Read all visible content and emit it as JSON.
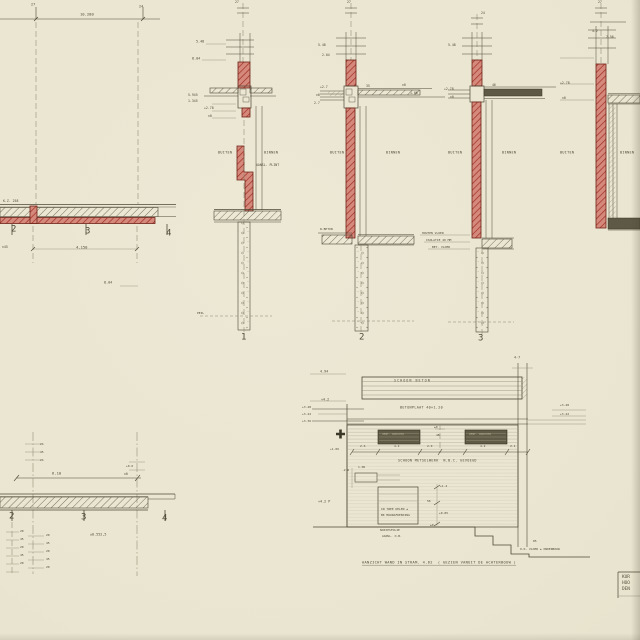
{
  "title_block": {
    "line1": "KUR",
    "line2": "HOO",
    "line3": "DEN"
  },
  "caption": "AANZICHT WAND IN STRAM. 4.62  ( GEZIEN VANUIT DE ACHTERBOUW )",
  "colors": {
    "paper": "#e9e5d0",
    "ink": "#4d4836",
    "red_fill": "#d5897c",
    "red_hatch": "#9e2f22",
    "dark_slab": "#5e5946",
    "faint": "#8a8570"
  },
  "annotations": [
    {
      "t": "27",
      "x": 31,
      "y": 3,
      "s": 3.5
    },
    {
      "t": "24",
      "x": 139,
      "y": 5,
      "s": 3.5
    },
    {
      "t": "10.280",
      "x": 80,
      "y": 13,
      "s": 3.8
    },
    {
      "t": "K.Z. 258",
      "x": 3,
      "y": 200,
      "s": 3.2
    },
    {
      "t": "2",
      "x": 11,
      "y": 225,
      "s": 9,
      "n": "grid-number-2"
    },
    {
      "t": "3",
      "x": 85,
      "y": 227,
      "s": 9,
      "n": "grid-number-3"
    },
    {
      "t": "4",
      "x": 166,
      "y": 229,
      "s": 9,
      "n": "grid-number-4"
    },
    {
      "t": "±45",
      "x": 2,
      "y": 246,
      "s": 3.2
    },
    {
      "t": "4.150",
      "x": 76,
      "y": 246,
      "s": 3.8
    },
    {
      "t": "8.04",
      "x": 104,
      "y": 281,
      "s": 3.4
    },
    {
      "t": "27",
      "x": 235,
      "y": 1,
      "s": 3.2
    },
    {
      "t": "27",
      "x": 347,
      "y": 1,
      "s": 3.2
    },
    {
      "t": "24",
      "x": 481,
      "y": 12,
      "s": 3.2
    },
    {
      "t": "27",
      "x": 598,
      "y": 1,
      "s": 3.2
    },
    {
      "t": "5.48",
      "x": 196,
      "y": 40,
      "s": 3.4
    },
    {
      "t": "8.04",
      "x": 192,
      "y": 57,
      "s": 3.4
    },
    {
      "t": "5.945",
      "x": 188,
      "y": 94,
      "s": 3.2
    },
    {
      "t": "1.345",
      "x": 188,
      "y": 100,
      "s": 3.2
    },
    {
      "t": "+2.78",
      "x": 204,
      "y": 107,
      "s": 3.2
    },
    {
      "t": "±0",
      "x": 208,
      "y": 115,
      "s": 3.2
    },
    {
      "t": "5.48",
      "x": 318,
      "y": 44,
      "s": 3.2
    },
    {
      "t": "2.04",
      "x": 322,
      "y": 54,
      "s": 3.2
    },
    {
      "t": "+2.7",
      "x": 320,
      "y": 86,
      "s": 3.2
    },
    {
      "t": "±0",
      "x": 316,
      "y": 94,
      "s": 3.2
    },
    {
      "t": "2.7",
      "x": 314,
      "y": 102,
      "s": 3.2
    },
    {
      "t": "35",
      "x": 366,
      "y": 85,
      "s": 3.2
    },
    {
      "t": "±0",
      "x": 402,
      "y": 84,
      "s": 3.2
    },
    {
      "t": "1.06",
      "x": 410,
      "y": 92,
      "s": 3.2
    },
    {
      "t": "5.48",
      "x": 448,
      "y": 44,
      "s": 3.2
    },
    {
      "t": "+2.78",
      "x": 444,
      "y": 88,
      "s": 3.2
    },
    {
      "t": "±0",
      "x": 450,
      "y": 96,
      "s": 3.2
    },
    {
      "t": "46",
      "x": 492,
      "y": 84,
      "s": 3.2
    },
    {
      "t": "4.2",
      "x": 592,
      "y": 30,
      "s": 3.2
    },
    {
      "t": "7.56",
      "x": 606,
      "y": 36,
      "s": 3.2
    },
    {
      "t": "+2.78",
      "x": 560,
      "y": 82,
      "s": 3.2
    },
    {
      "t": "±0",
      "x": 562,
      "y": 97,
      "s": 3.2
    },
    {
      "t": "BUITEN",
      "x": 218,
      "y": 151,
      "s": 3.4,
      "ls": 1
    },
    {
      "t": "BINNEN",
      "x": 264,
      "y": 151,
      "s": 3.4,
      "ls": 1
    },
    {
      "t": "AANSL. PLINT",
      "x": 256,
      "y": 164,
      "s": 3.2
    },
    {
      "t": "BUITEN",
      "x": 330,
      "y": 151,
      "s": 3.4,
      "ls": 1
    },
    {
      "t": "BINNEN",
      "x": 386,
      "y": 151,
      "s": 3.4,
      "ls": 1
    },
    {
      "t": "BUITEN",
      "x": 448,
      "y": 151,
      "s": 3.4,
      "ls": 1
    },
    {
      "t": "BINNEN",
      "x": 502,
      "y": 151,
      "s": 3.4,
      "ls": 1
    },
    {
      "t": "BUITEN",
      "x": 560,
      "y": 151,
      "s": 3.4,
      "ls": 1
    },
    {
      "t": "BINNEN",
      "x": 620,
      "y": 151,
      "s": 3.4,
      "ls": 1
    },
    {
      "t": "PEIL",
      "x": 197,
      "y": 312,
      "s": 3
    },
    {
      "t": "R.BETON",
      "x": 320,
      "y": 228,
      "s": 3
    },
    {
      "t": "HOUTEN VLOER",
      "x": 422,
      "y": 232,
      "s": 3
    },
    {
      "t": "ISOLATIE 40 MM",
      "x": 426,
      "y": 239,
      "s": 3
    },
    {
      "t": "BET. VLOER",
      "x": 432,
      "y": 246,
      "s": 3
    },
    {
      "t": "1",
      "x": 241,
      "y": 333,
      "s": 9,
      "n": "section-number-1"
    },
    {
      "t": "2",
      "x": 359,
      "y": 333,
      "s": 9,
      "n": "section-number-2"
    },
    {
      "t": "3",
      "x": 478,
      "y": 334,
      "s": 9,
      "n": "section-number-3"
    },
    {
      "t": "24",
      "x": 40,
      "y": 443,
      "s": 3
    },
    {
      "t": "45",
      "x": 40,
      "y": 451,
      "s": 3
    },
    {
      "t": "24",
      "x": 40,
      "y": 459,
      "s": 3
    },
    {
      "t": "+0.6",
      "x": 126,
      "y": 465,
      "s": 3
    },
    {
      "t": "6.10",
      "x": 52,
      "y": 472,
      "s": 3.8
    },
    {
      "t": "±0",
      "x": 124,
      "y": 473,
      "s": 3.2
    },
    {
      "t": "2",
      "x": 9,
      "y": 512,
      "s": 9,
      "n": "grid-number-2b"
    },
    {
      "t": "3",
      "x": 81,
      "y": 513,
      "s": 9,
      "n": "grid-number-3b"
    },
    {
      "t": "4",
      "x": 162,
      "y": 514,
      "s": 9,
      "n": "grid-number-4b"
    },
    {
      "t": "±0.552,5",
      "x": 90,
      "y": 533,
      "s": 3.4
    },
    {
      "t": "20",
      "x": 20,
      "y": 530,
      "s": 3
    },
    {
      "t": "45",
      "x": 20,
      "y": 538,
      "s": 3
    },
    {
      "t": "20",
      "x": 20,
      "y": 546,
      "s": 3
    },
    {
      "t": "45",
      "x": 20,
      "y": 554,
      "s": 3
    },
    {
      "t": "20",
      "x": 20,
      "y": 562,
      "s": 3
    },
    {
      "t": "20",
      "x": 46,
      "y": 534,
      "s": 3
    },
    {
      "t": "45",
      "x": 46,
      "y": 542,
      "s": 3
    },
    {
      "t": "20",
      "x": 46,
      "y": 550,
      "s": 3
    },
    {
      "t": "45",
      "x": 46,
      "y": 558,
      "s": 3
    },
    {
      "t": "20",
      "x": 46,
      "y": 566,
      "s": 3
    },
    {
      "t": "4.94",
      "x": 320,
      "y": 370,
      "s": 3.4
    },
    {
      "t": "SCHOON BETON",
      "x": 394,
      "y": 379,
      "s": 3.4,
      "ls": 3
    },
    {
      "t": "+4.2",
      "x": 321,
      "y": 398,
      "s": 3.4
    },
    {
      "t": "BETONPLAAT 40×1.20",
      "x": 400,
      "y": 406,
      "s": 3.4,
      "ls": 1
    },
    {
      "t": "+3.48",
      "x": 302,
      "y": 406,
      "s": 3
    },
    {
      "t": "+3.42",
      "x": 302,
      "y": 413,
      "s": 3
    },
    {
      "t": "+3.36",
      "x": 302,
      "y": 420,
      "s": 3
    },
    {
      "t": "+3.48",
      "x": 560,
      "y": 404,
      "s": 3
    },
    {
      "t": "+3.42",
      "x": 560,
      "y": 413,
      "s": 3
    },
    {
      "t": "4-7",
      "x": 514,
      "y": 356,
      "s": 3.4
    },
    {
      "t": "VENT. ROOSTER",
      "x": 382,
      "y": 433,
      "s": 2.8,
      "c": "light"
    },
    {
      "t": "VENT. ROOSTER",
      "x": 469,
      "y": 433,
      "s": 2.8,
      "c": "light"
    },
    {
      "t": "±0",
      "x": 434,
      "y": 426,
      "s": 3
    },
    {
      "t": "48",
      "x": 436,
      "y": 434,
      "s": 3
    },
    {
      "t": "+1.06",
      "x": 330,
      "y": 448,
      "s": 3
    },
    {
      "t": "2.6",
      "x": 360,
      "y": 445,
      "s": 3
    },
    {
      "t": "4.2",
      "x": 394,
      "y": 445,
      "s": 3
    },
    {
      "t": "2.0",
      "x": 427,
      "y": 445,
      "s": 3
    },
    {
      "t": "4.2",
      "x": 480,
      "y": 445,
      "s": 3
    },
    {
      "t": "2.1",
      "x": 510,
      "y": 445,
      "s": 3
    },
    {
      "t": "SCHOON METSELWERK  N.B.C. GEVOEGD",
      "x": 398,
      "y": 459,
      "s": 3.4,
      "ls": 1
    },
    {
      "t": "-2.6",
      "x": 342,
      "y": 469,
      "s": 3
    },
    {
      "t": "1.06",
      "x": 358,
      "y": 466,
      "s": 3
    },
    {
      "t": "+4.2 P",
      "x": 318,
      "y": 500,
      "s": 3.4
    },
    {
      "t": "IN TWEE DELEN ±",
      "x": 381,
      "y": 508,
      "s": 3
    },
    {
      "t": "BK MUURAFDEKKING",
      "x": 381,
      "y": 514,
      "s": 3
    },
    {
      "t": "+1.4",
      "x": 440,
      "y": 485,
      "s": 3
    },
    {
      "t": "56",
      "x": 427,
      "y": 500,
      "s": 3
    },
    {
      "t": "+0.85",
      "x": 439,
      "y": 512,
      "s": 3
    },
    {
      "t": "NOPJESFOLIE",
      "x": 380,
      "y": 529,
      "s": 3
    },
    {
      "t": "AANSL. O.B.",
      "x": 382,
      "y": 535,
      "s": 3
    },
    {
      "t": "±0",
      "x": 430,
      "y": 524,
      "s": 3
    },
    {
      "t": "85",
      "x": 533,
      "y": 540,
      "s": 3
    },
    {
      "t": "O.K. VLOER ± ONDERBOUW",
      "x": 520,
      "y": 548,
      "s": 3
    }
  ]
}
